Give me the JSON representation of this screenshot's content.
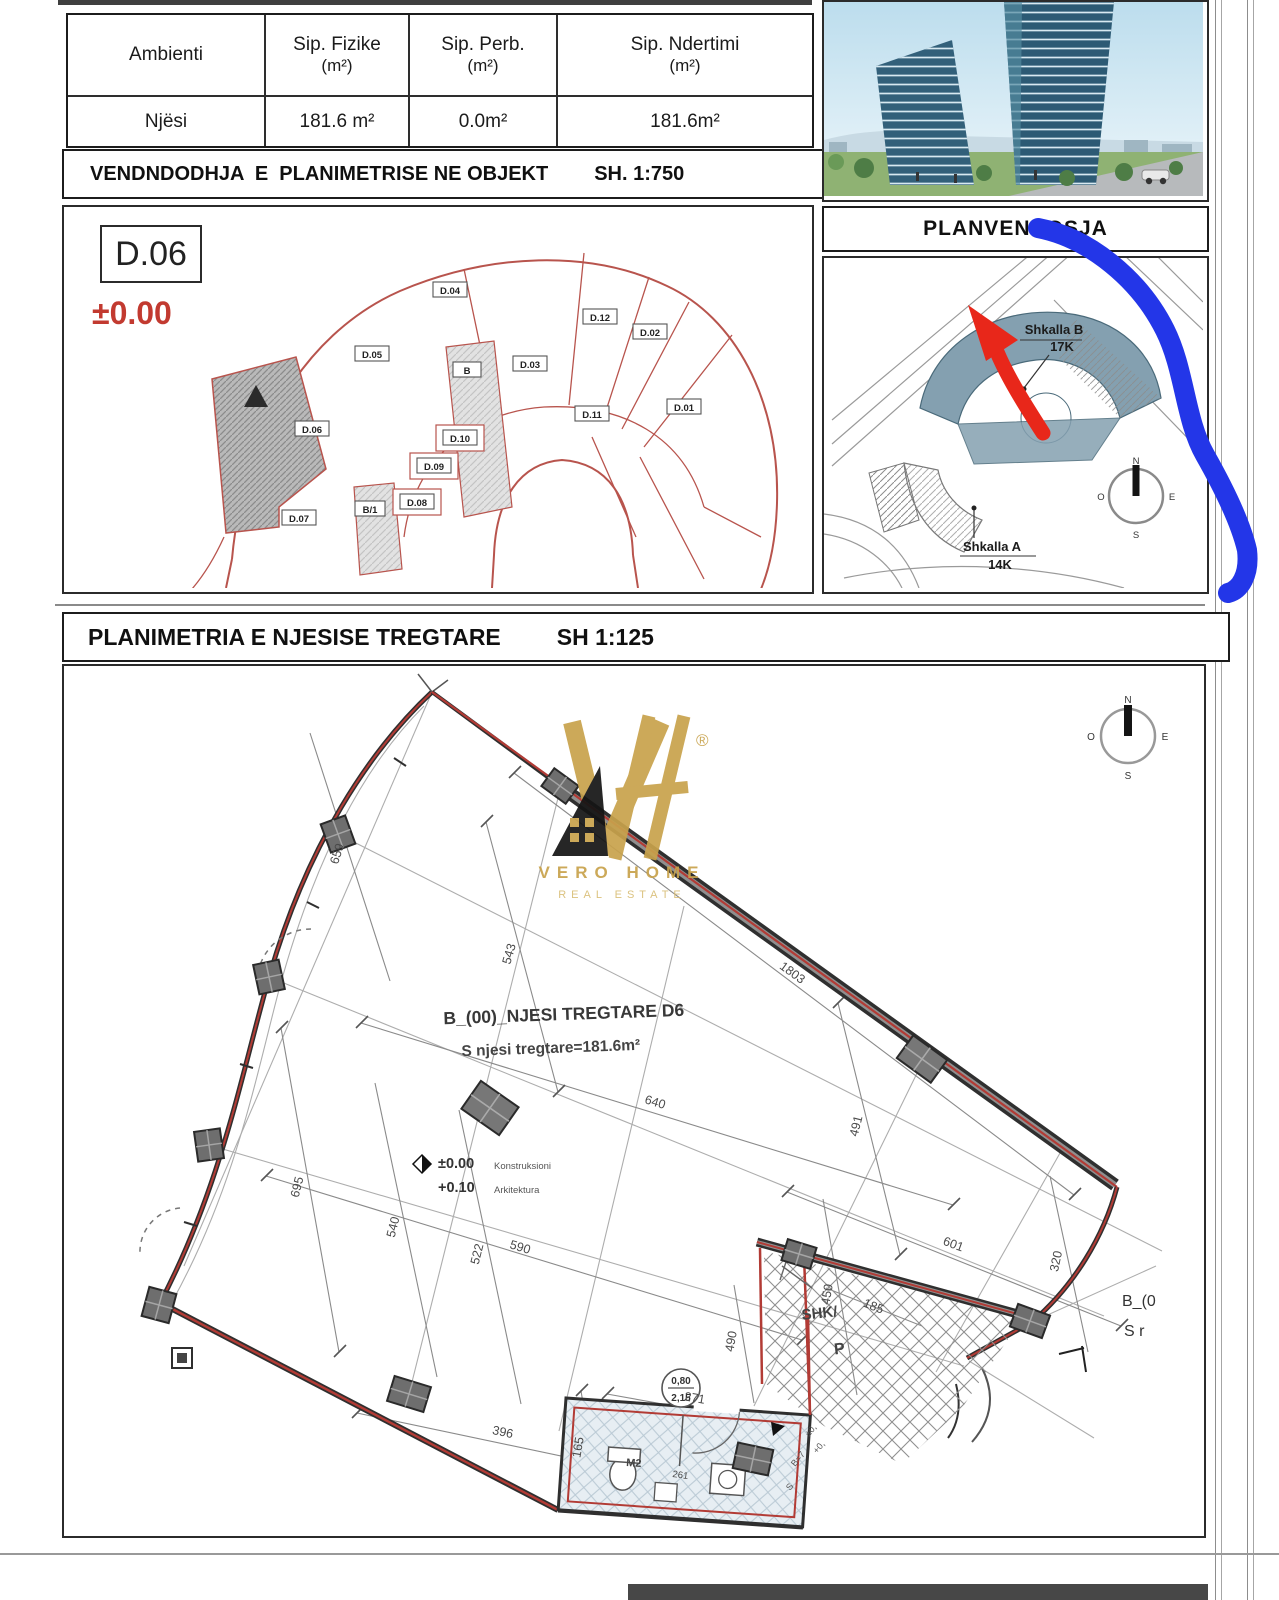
{
  "table": {
    "columns": [
      {
        "title": "Ambienti",
        "unit": ""
      },
      {
        "title": "Sip. Fizike",
        "unit": "(m²)"
      },
      {
        "title": "Sip. Perb.",
        "unit": "(m²)"
      },
      {
        "title": "Sip. Ndertimi",
        "unit": "(m²)"
      }
    ],
    "row": {
      "label": "Njësi",
      "values": [
        "181.6 m²",
        "0.0m²",
        "181.6m²"
      ]
    }
  },
  "section1": {
    "title": "VENDNDODHJA  E  PLANIMETRISE NE OBJEKT",
    "scale": "SH. 1:750"
  },
  "locplan": {
    "badge": "D.06",
    "level": "±0.00",
    "units": [
      "D.04",
      "D.12",
      "D.02",
      "D.05",
      "B",
      "D.03",
      "D.01",
      "D.11",
      "D.06",
      "D.10",
      "D.09",
      "D.08",
      "B/1",
      "D.07"
    ]
  },
  "planvendosja": {
    "title": "PLANVENDOSJA"
  },
  "siteplan": {
    "stair_b": {
      "name": "Shkalla B",
      "floors": "17K"
    },
    "stair_a": {
      "name": "Shkalla A",
      "floors": "14K"
    },
    "compass": {
      "n": "N",
      "o": "O",
      "e": "E",
      "s": "S"
    }
  },
  "section2": {
    "title": "PLANIMETRIA E NJESISE TREGTARE",
    "scale": "SH 1:125"
  },
  "plan": {
    "unit_title": "B_(00)_NJESI TREGTARE D6",
    "unit_area": "S njesi tregtare=181.6m²",
    "level_constr": "±0.00",
    "level_constr_label": "Konstruksioni",
    "level_arch": "+0.10",
    "level_arch_label": "Arkitektura",
    "stair_label": "SHK/",
    "stair_sub": "P",
    "door_circle_top": "0,80",
    "door_circle_bottom": "2,15",
    "room_label": "M2",
    "right_text_1": "B_(0",
    "right_text_2": "S r",
    "mark_1": "±0,",
    "mark_2": "+0,",
    "mark_3": "B=7",
    "mark_4": "S",
    "dims": [
      "590",
      "640",
      "695",
      "540",
      "522",
      "543",
      "659",
      "1803",
      "491",
      "601",
      "320",
      "450",
      "490",
      "165",
      "271",
      "396",
      "185",
      "261"
    ],
    "compass": {
      "n": "N",
      "o": "O",
      "e": "E",
      "s": "S"
    }
  },
  "watermark": {
    "reg": "®",
    "line1": "VERO HOME",
    "line2": "REAL ESTATE"
  }
}
